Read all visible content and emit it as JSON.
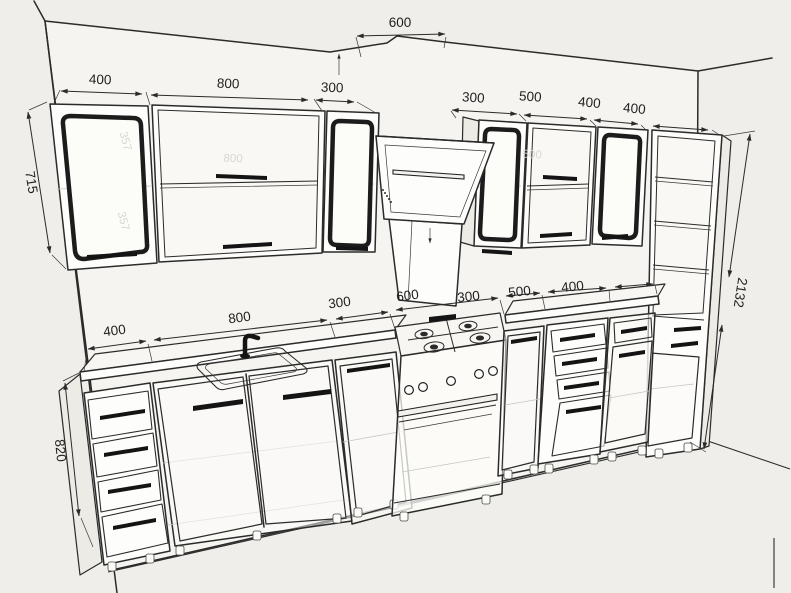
{
  "diagram": {
    "title": "kitchen-cabinets-perspective-technical-drawing",
    "dims": {
      "upper_left": [
        "400",
        "800",
        "300"
      ],
      "hood_top": "600",
      "upper_right": [
        "300",
        "500",
        "400",
        "400"
      ],
      "lower": [
        "400",
        "800",
        "300",
        "600",
        "300",
        "500",
        "400"
      ],
      "wall_cab_height": "715",
      "base_height": "820",
      "tall_height": "2132"
    },
    "ghost_labels": {
      "left_door_top": "357",
      "left_door_bottom": "357",
      "cab800": "800",
      "cab500": "500"
    },
    "colors": {
      "background": "#efeeea",
      "wall": "#f5f4f0",
      "line": "#2b2b2b",
      "cabinet_face": "#fdfdfb",
      "cabinet_side": "#edebe6",
      "handle": "#141414",
      "ghost_text": "#d8d7d2"
    }
  }
}
